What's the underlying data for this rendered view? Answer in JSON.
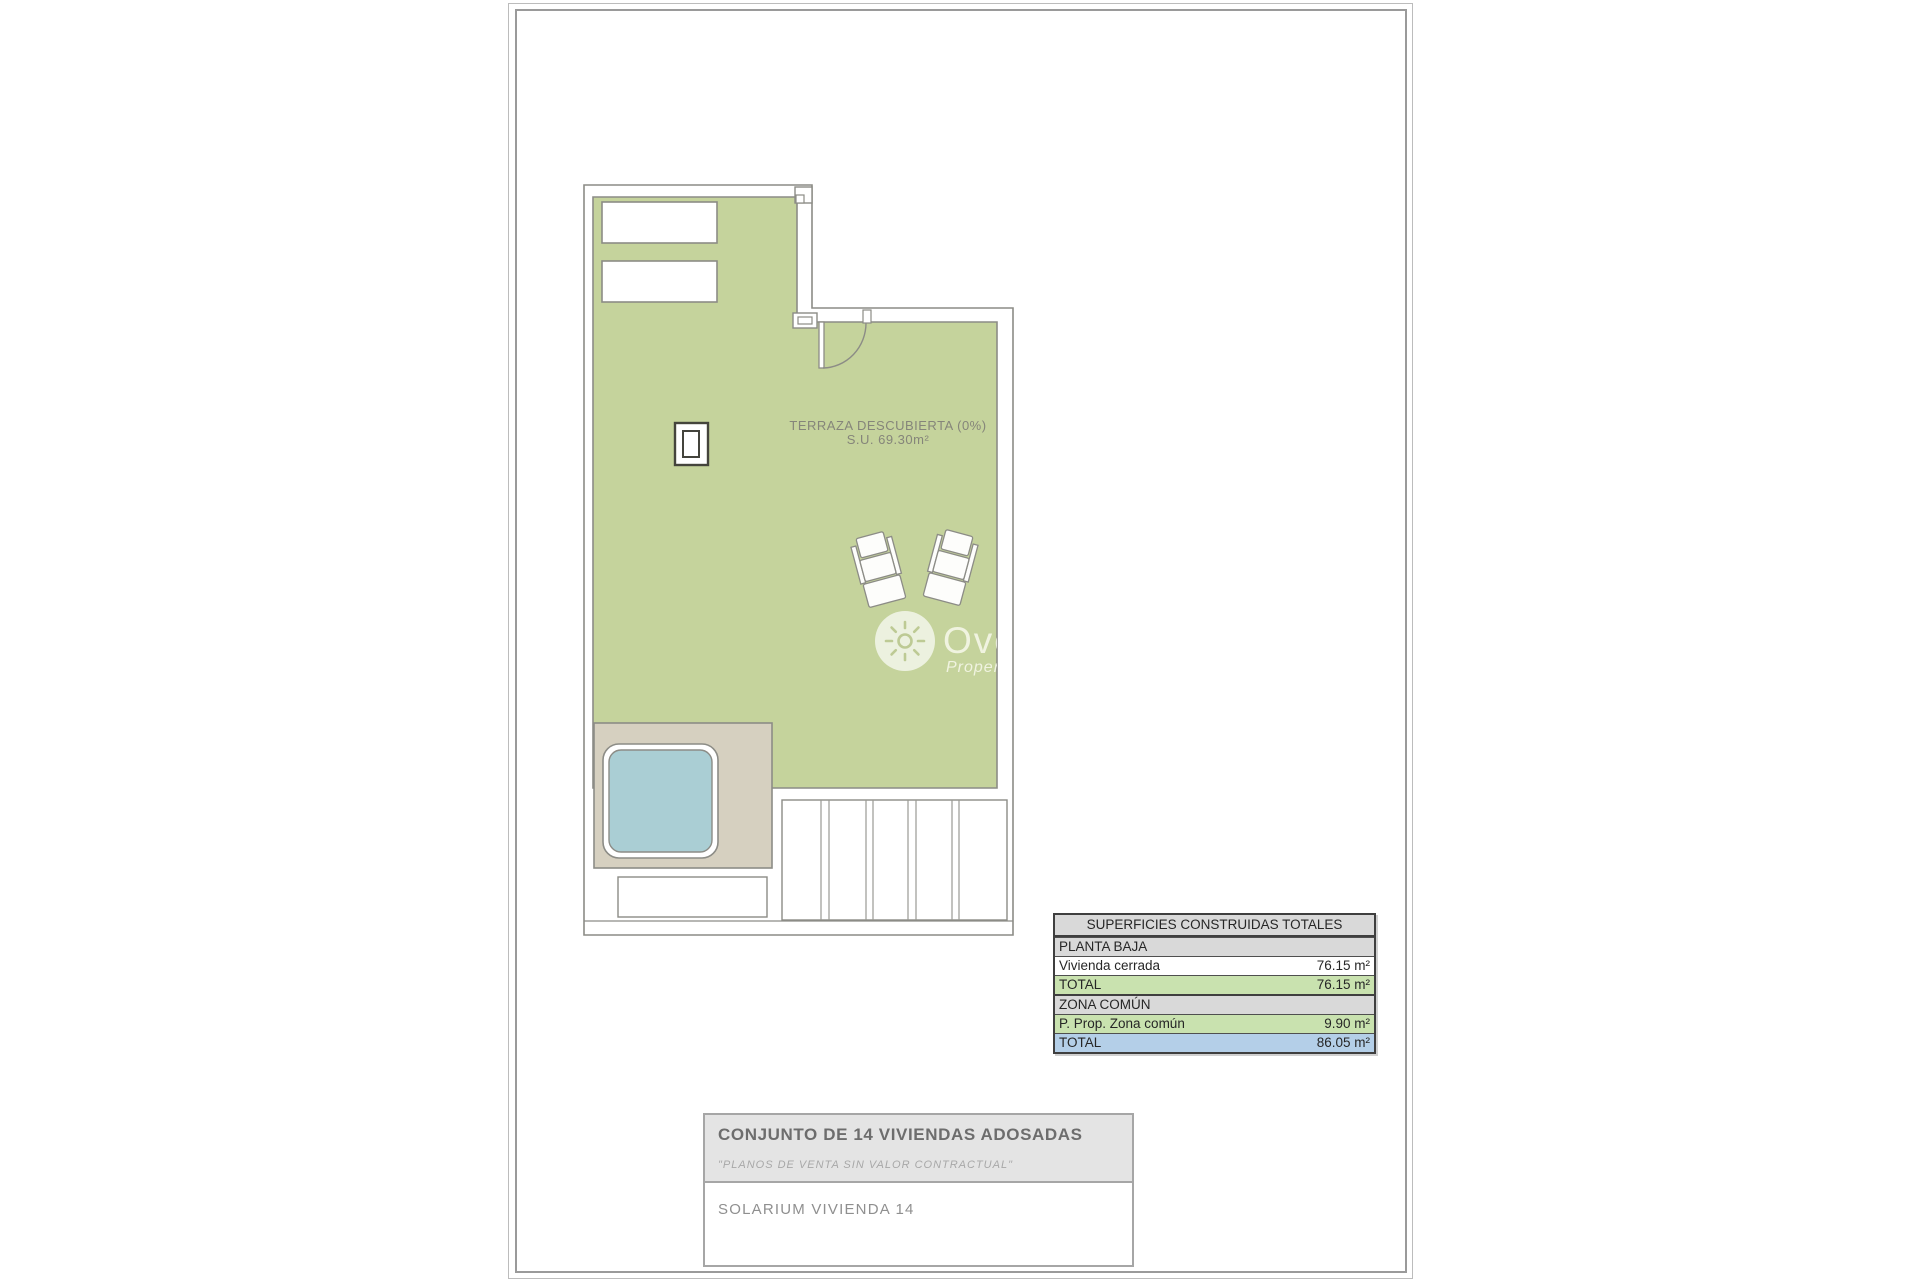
{
  "plan": {
    "terrace_label": "TERRAZA DESCUBIERTA (0%)",
    "terrace_area": "S.U. 69.30m²"
  },
  "watermark": {
    "brand": "Overse",
    "tagline": "Property M"
  },
  "surfaces_table": {
    "header": "SUPERFICIES CONSTRUIDAS TOTALES",
    "rows": [
      {
        "label": "PLANTA BAJA",
        "value": ""
      },
      {
        "label": "Vivienda cerrada",
        "value": "76.15 m²"
      },
      {
        "label": "TOTAL",
        "value": "76.15 m²"
      },
      {
        "label": "ZONA COMÚN",
        "value": ""
      },
      {
        "label": "P. Prop. Zona común",
        "value": "9.90 m²"
      },
      {
        "label": "TOTAL",
        "value": "86.05 m²"
      }
    ]
  },
  "title_block": {
    "project": "CONJUNTO DE 14 VIVIENDAS ADOSADAS",
    "disclaimer": "\"PLANOS DE VENTA SIN VALOR CONTRACTUAL\"",
    "drawing": "SOLARIUM VIVIENDA 14"
  },
  "colors": {
    "terrace_green": "#c5d39c",
    "deck_beige": "#d6d0c0",
    "pool_blue": "#aaced4",
    "table_green": "#c9e2af",
    "table_blue": "#b4cfe8",
    "table_gray": "#d9d9d9",
    "wall_line": "#8c8c86"
  }
}
